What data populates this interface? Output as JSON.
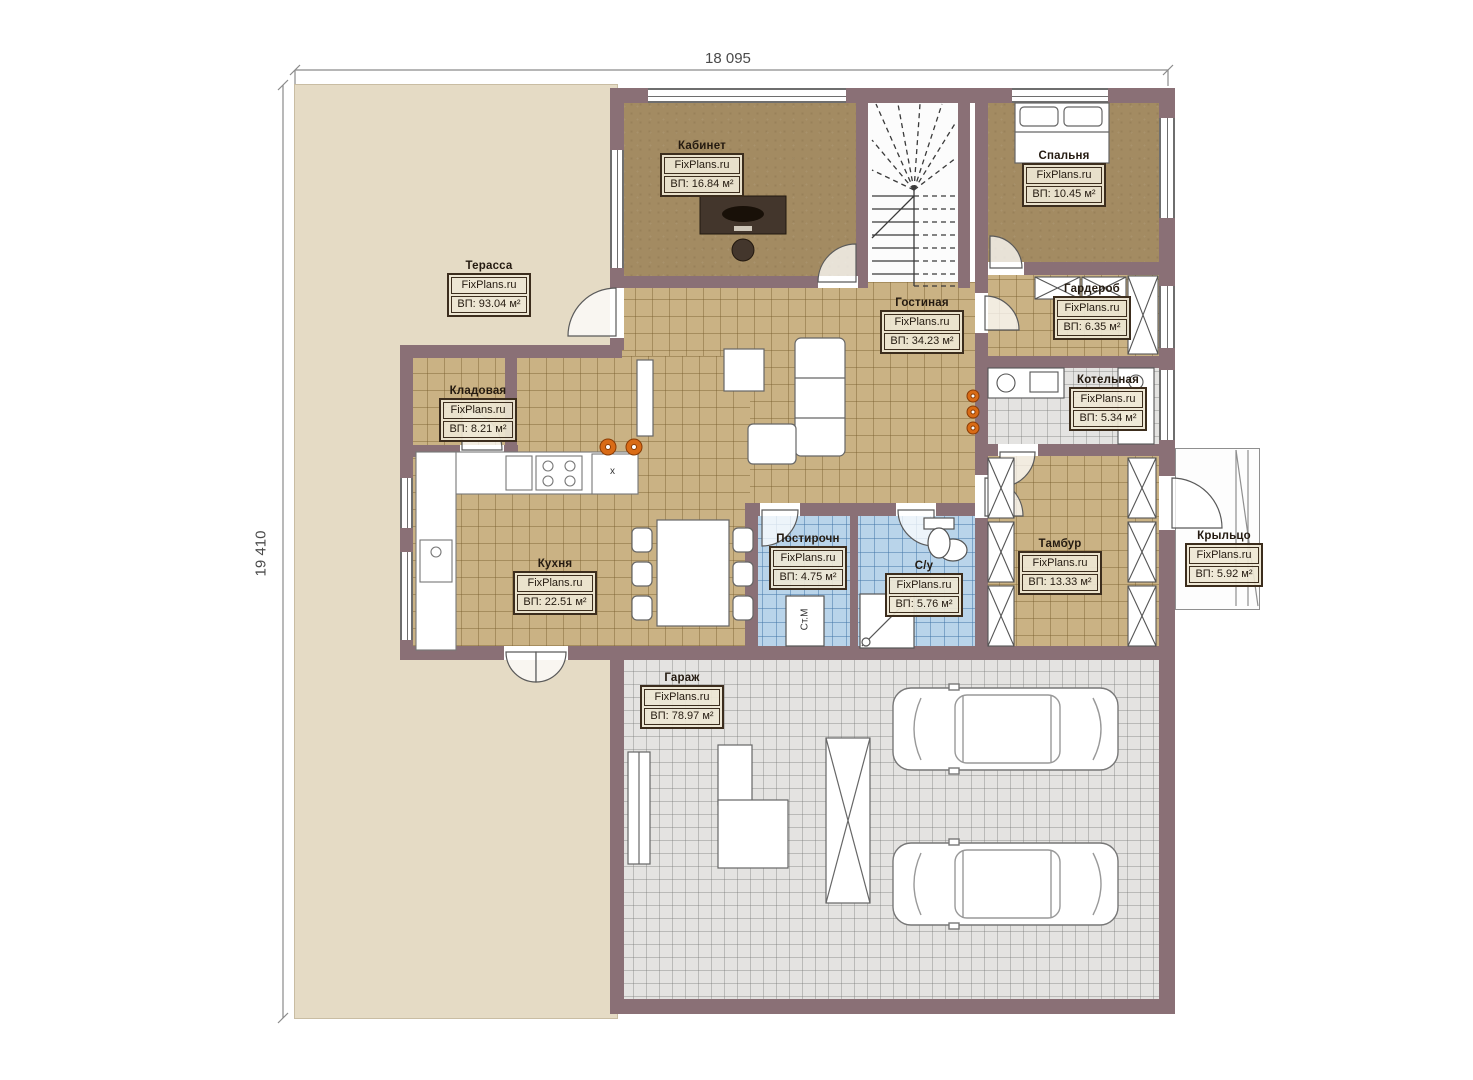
{
  "dims": {
    "top": "18 095",
    "left": "19 410"
  },
  "watermark": "FixPlans.ru",
  "rooms": {
    "terrace": {
      "name": "Терасса",
      "brand": "FixPlans.ru",
      "area": "ВП: 93.04 м²"
    },
    "office": {
      "name": "Кабинет",
      "brand": "FixPlans.ru",
      "area": "ВП: 16.84 м²"
    },
    "bedroom": {
      "name": "Спальня",
      "brand": "FixPlans.ru",
      "area": "ВП: 10.45 м²"
    },
    "living": {
      "name": "Гостиная",
      "brand": "FixPlans.ru",
      "area": "ВП: 34.23 м²"
    },
    "wardrobe": {
      "name": "Гардероб",
      "brand": "FixPlans.ru",
      "area": "ВП: 6.35 м²"
    },
    "boiler": {
      "name": "Котельная",
      "brand": "FixPlans.ru",
      "area": "ВП: 5.34 м²"
    },
    "pantry": {
      "name": "Кладовая",
      "brand": "FixPlans.ru",
      "area": "ВП: 8.21 м²"
    },
    "kitchen": {
      "name": "Кухня",
      "brand": "FixPlans.ru",
      "area": "ВП: 22.51 м²"
    },
    "laundry": {
      "name": "Постирочн",
      "brand": "FixPlans.ru",
      "area": "ВП: 4.75 м²"
    },
    "bathroom": {
      "name": "С/у",
      "brand": "FixPlans.ru",
      "area": "ВП: 5.76 м²"
    },
    "vestibule": {
      "name": "Тамбур",
      "brand": "FixPlans.ru",
      "area": "ВП: 13.33 м²"
    },
    "porch": {
      "name": "Крыльцо",
      "brand": "FixPlans.ru",
      "area": "ВП: 5.92 м²"
    },
    "garage": {
      "name": "Гараж",
      "brand": "FixPlans.ru",
      "area": "ВП: 78.97 м²"
    }
  },
  "annotations": {
    "washer": "Ст.М",
    "x_marker": "x"
  },
  "colors": {
    "wall": "#8a7076",
    "terrace": "#e5dbc5",
    "wood": "#a38b62",
    "tile_tan": "#cab284",
    "tile_blue": "#b9d4ea",
    "tile_gray": "#e4e3e1",
    "accent_orange": "#d96b16",
    "label_border": "#3c2d1d"
  }
}
